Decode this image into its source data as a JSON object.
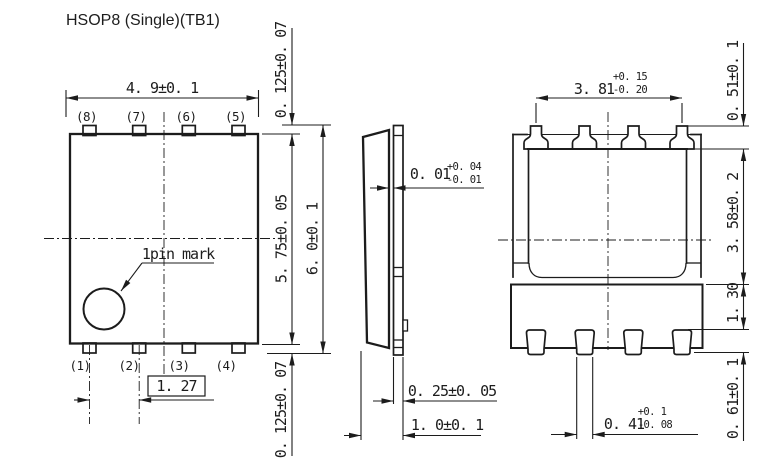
{
  "title": "HSOP8 (Single)(TB1)",
  "colors": {
    "line": "#1c1c1c",
    "background": "#ffffff"
  },
  "top_view": {
    "pin_labels_top": [
      "(8)",
      "(7)",
      "(6)",
      "(5)"
    ],
    "pin_labels_bottom": [
      "(1)",
      "(2)",
      "(3)",
      "(4)"
    ],
    "pin_mark_label": "1pin mark",
    "dim_body_width": "4. 9±0. 1",
    "dim_pin_pitch": "1. 27",
    "dim_body_length": "5. 75±0. 05",
    "dim_total_length": "6. 0±0. 1",
    "dim_pin_protrusion_top": "0. 125±0. 07",
    "dim_pin_protrusion_bottom": "0. 125±0. 07"
  },
  "side_view": {
    "dim_standoff": {
      "value": "0. 01",
      "tol_plus": "+0. 04",
      "tol_minus": "-0. 01"
    },
    "dim_lead_thickness": "0. 25±0. 05",
    "dim_package_height": "1. 0±0. 1"
  },
  "back_view": {
    "dim_lead_span": {
      "value": "3. 81",
      "tol_plus": "+0. 15",
      "tol_minus": "-0. 20"
    },
    "dim_top_lead_height": "0. 51±0. 1",
    "dim_body_height": "3. 58±0. 2",
    "dim_pad_height": "1. 30",
    "dim_bottom_lead_height": "0. 61±0. 1",
    "dim_lead_width": {
      "value": "0. 41",
      "tol_plus": "+0. 1",
      "tol_minus": "-0. 08"
    }
  }
}
